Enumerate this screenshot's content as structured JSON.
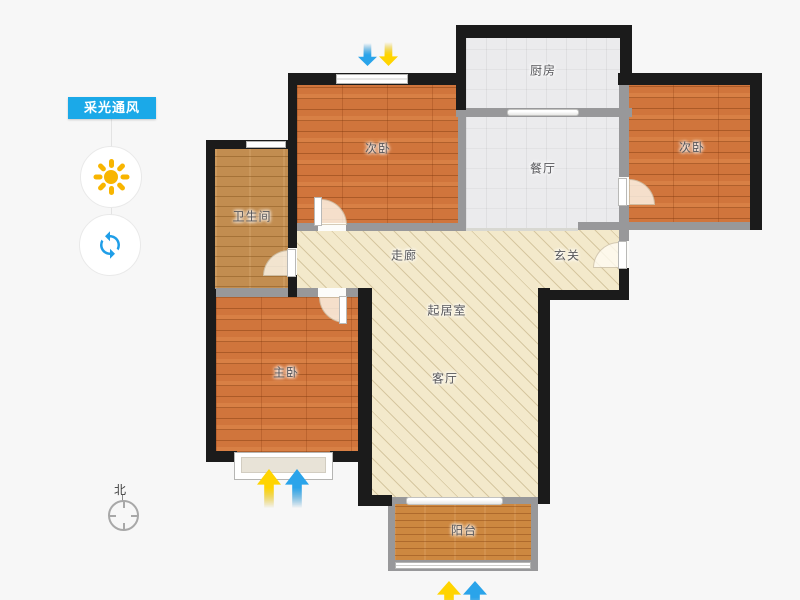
{
  "side_panel": {
    "tag_label": "采光通风",
    "tag_color": "#1ba9e8",
    "buttons": [
      {
        "id": "sunlight",
        "icon": "sun-icon",
        "color": "#f8b500"
      },
      {
        "id": "ventilation",
        "icon": "refresh-icon",
        "color": "#1f9ee8"
      }
    ]
  },
  "compass": {
    "north_label": "北"
  },
  "floorplan": {
    "rooms": {
      "kitchen": {
        "label": "厨房"
      },
      "bedroom_top_left": {
        "label": "次卧"
      },
      "bedroom_top_right": {
        "label": "次卧"
      },
      "dining": {
        "label": "餐厅"
      },
      "bathroom": {
        "label": "卫生间"
      },
      "corridor": {
        "label": "走廊"
      },
      "foyer": {
        "label": "玄关"
      },
      "sitting": {
        "label": "起居室"
      },
      "master": {
        "label": "主卧"
      },
      "living": {
        "label": "客厅"
      },
      "balcony": {
        "label": "阳台"
      }
    },
    "colors": {
      "exterior_wall": "#1b1b1b",
      "interior_wall": "#98989a",
      "bedroom_floor": "#d0753c",
      "bathroom_floor": "#c28d50",
      "tile_floor": "#ebebed",
      "hatch_floor": "#f3e9cb",
      "balcony_floor": "#cd8840",
      "light_arrow": "#ffd400",
      "wind_arrow": "#2aa4ea"
    }
  }
}
